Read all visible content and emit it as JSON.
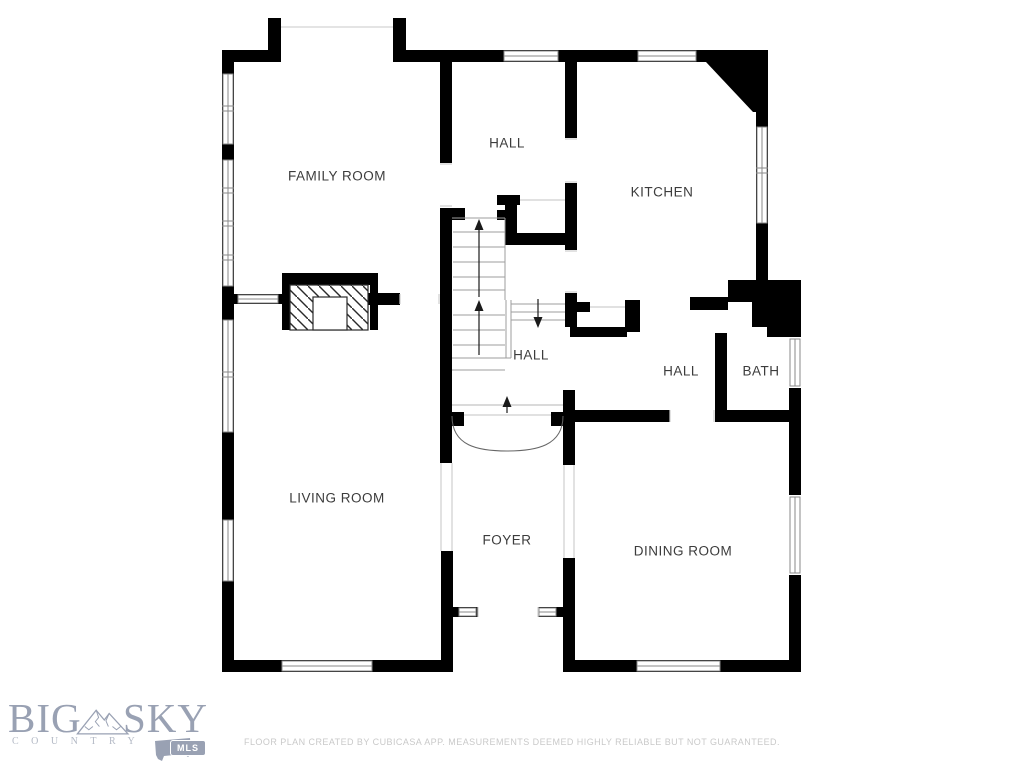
{
  "floor_plan": {
    "rooms": [
      {
        "id": "family-room",
        "label": "FAMILY ROOM"
      },
      {
        "id": "hall-upper",
        "label": "HALL"
      },
      {
        "id": "kitchen",
        "label": "KITCHEN"
      },
      {
        "id": "hall-stairs",
        "label": "HALL"
      },
      {
        "id": "hall-right",
        "label": "HALL"
      },
      {
        "id": "bath",
        "label": "BATH"
      },
      {
        "id": "living-room",
        "label": "LIVING ROOM"
      },
      {
        "id": "foyer",
        "label": "FOYER"
      },
      {
        "id": "dining-room",
        "label": "DINING ROOM"
      }
    ],
    "wall_color": "#000000",
    "label_color": "#3c3c3c",
    "stair_line_color": "#9e9e9e"
  },
  "branding": {
    "logo_word_1": "BIG",
    "logo_word_2": "SKY",
    "logo_subtitle": "COUNTRY",
    "logo_badge": "MLS",
    "logo_color": "#99a1b3"
  },
  "footer": {
    "disclaimer": "FLOOR PLAN CREATED BY CUBICASA APP. MEASUREMENTS DEEMED HIGHLY RELIABLE BUT NOT GUARANTEED."
  }
}
